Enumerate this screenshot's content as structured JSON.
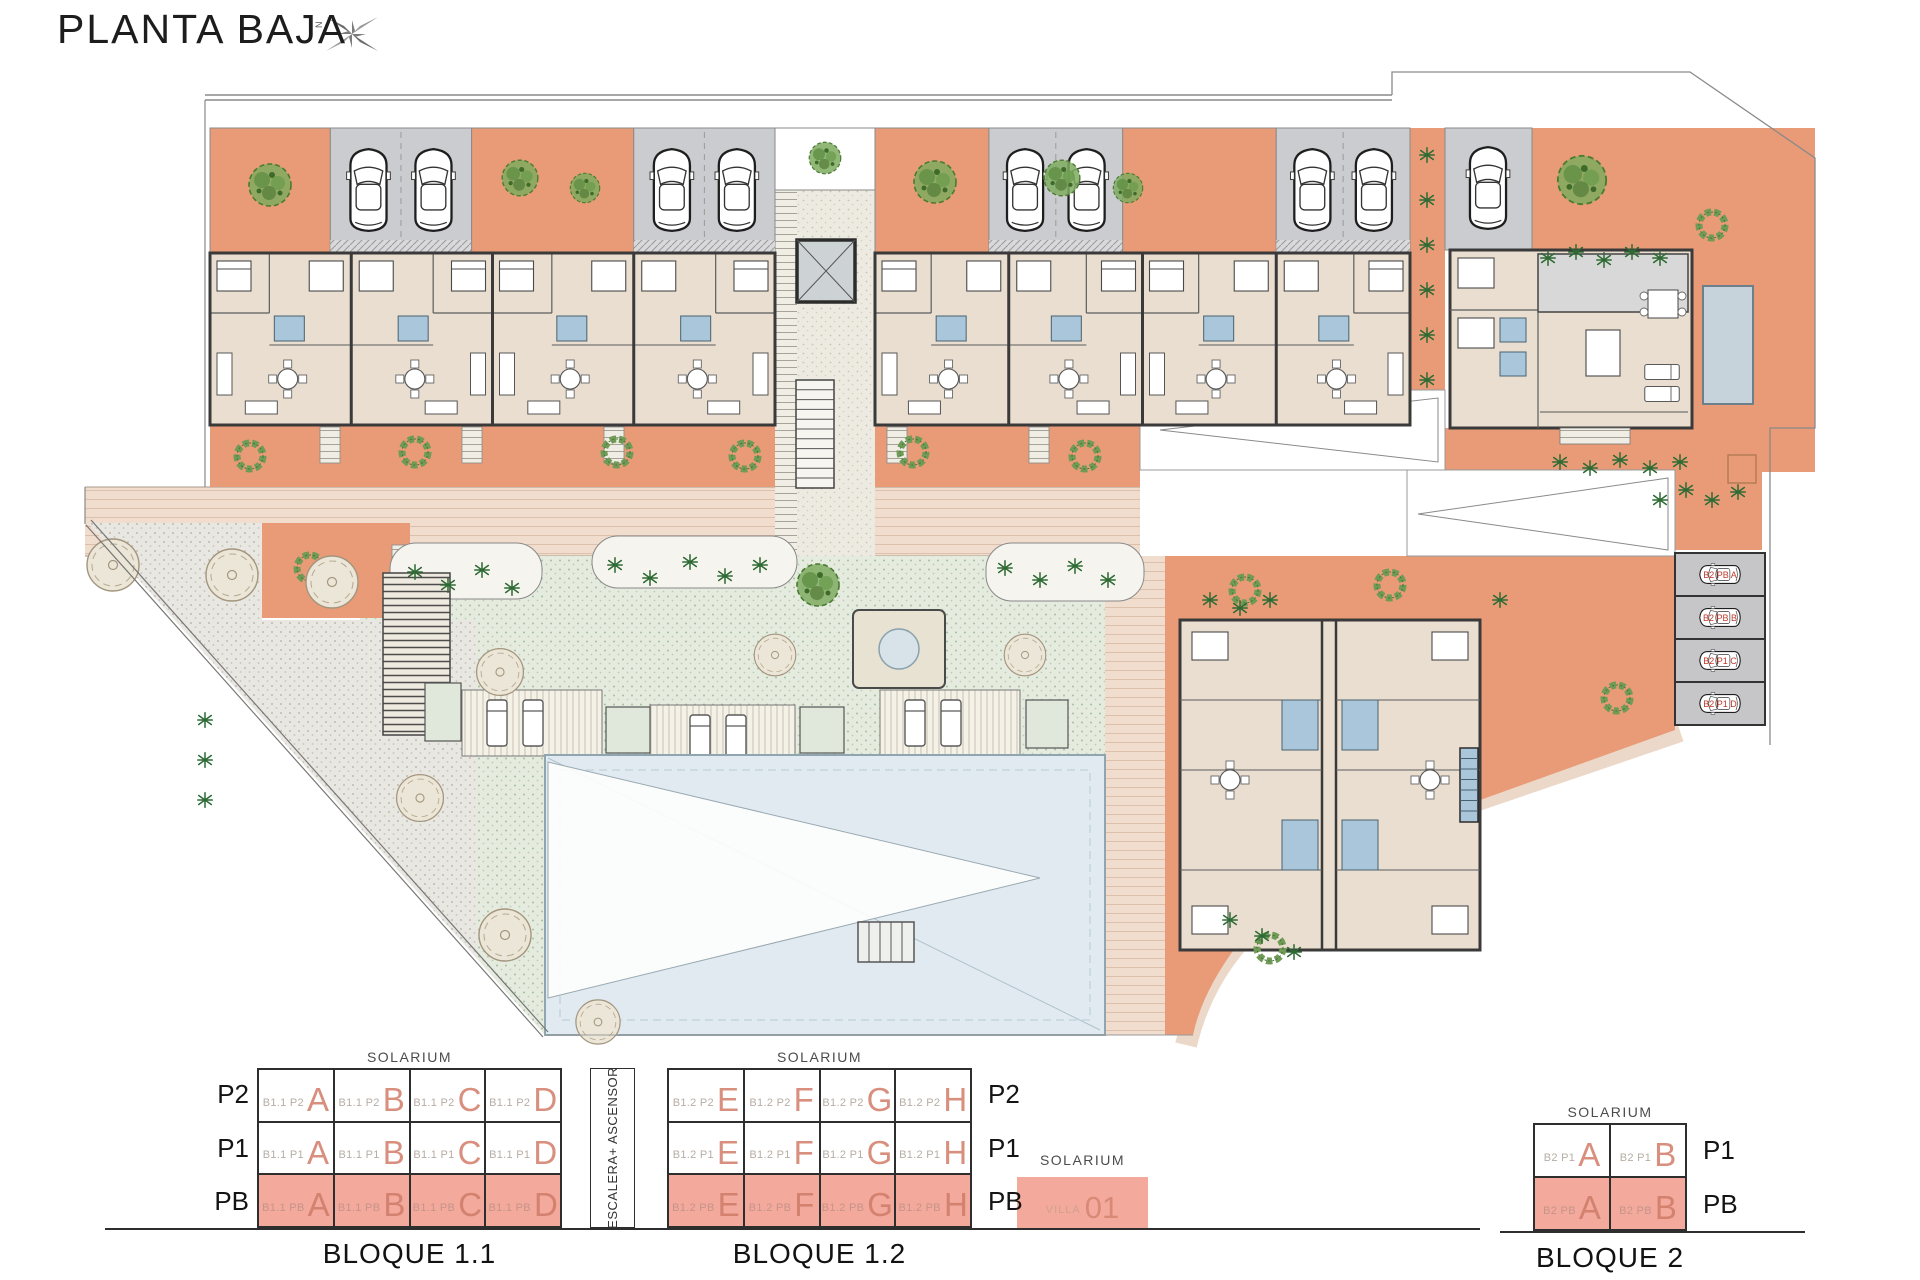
{
  "header": {
    "title": "PLANTA BAJA",
    "compass_north": "N"
  },
  "plan": {
    "parking_labels": [
      "B2 PB A",
      "B2 PB B",
      "B2 P1 C",
      "B2 P1 D"
    ]
  },
  "stairs_column_label": "ESCALERA+ ASCENSOR",
  "villa": {
    "solarium": "SOLARIUM",
    "label": "VILLA",
    "number": "01"
  },
  "legend_blocks": [
    {
      "name": "BLOQUE 1.1",
      "code": "B1.1",
      "solarium": "SOLARIUM",
      "floors": [
        "P2",
        "P1",
        "PB"
      ],
      "units": [
        "A",
        "B",
        "C",
        "D"
      ],
      "floor_labels_side": "left",
      "highlighted_floor": "PB"
    },
    {
      "name": "BLOQUE 1.2",
      "code": "B1.2",
      "solarium": "SOLARIUM",
      "floors": [
        "P2",
        "P1",
        "PB"
      ],
      "units": [
        "E",
        "F",
        "G",
        "H"
      ],
      "floor_labels_side": "right",
      "highlighted_floor": "PB"
    },
    {
      "name": "BLOQUE 2",
      "code": "B2",
      "solarium": "SOLARIUM",
      "floors": [
        "P1",
        "PB"
      ],
      "units": [
        "A",
        "B"
      ],
      "floor_labels_side": "right",
      "highlighted_floor": "PB"
    }
  ],
  "colors": {
    "terrace_orange": "#e89b76",
    "highlight_salmon": "#f3a99b",
    "unit_letter_salmon": "#d98f7e",
    "garage_gray": "#cbccd0",
    "lawn_green": "#e5ecdf",
    "pool_blue": "#e0eaf0",
    "bath_blue": "#a9c6da",
    "path_pink": "#f1ddcd"
  }
}
